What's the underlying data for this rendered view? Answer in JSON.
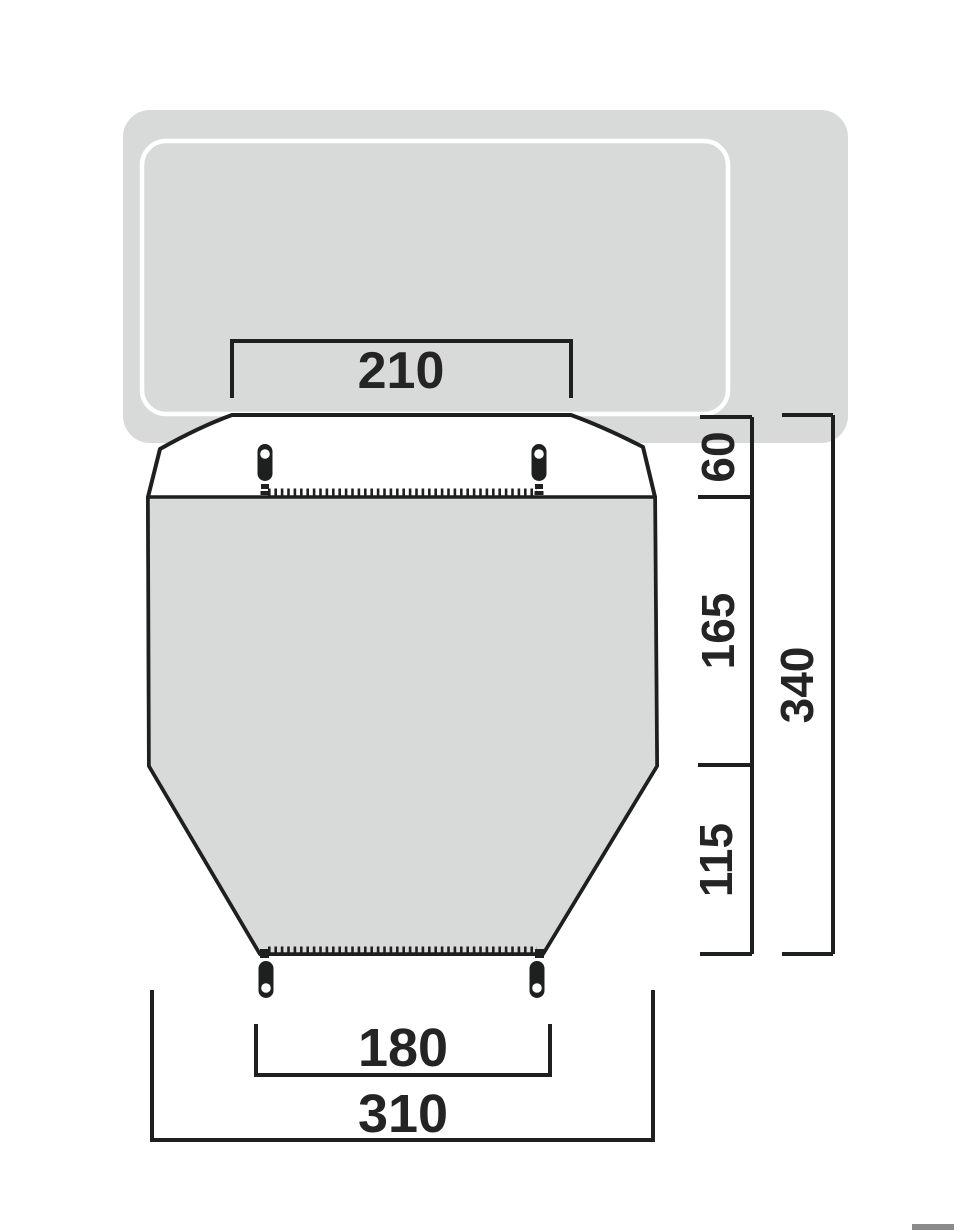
{
  "diagram": {
    "title": "tent-footprint-dimension-diagram",
    "measurements": {
      "attachment_width": "210",
      "connection_depth": "60",
      "main_section_depth": "165",
      "front_section_depth": "115",
      "total_depth": "340",
      "rear_ground_width": "180",
      "ground_width": "310"
    },
    "colors": {
      "vehicle_fill": "#d8dada",
      "tent_body_fill": "#d8dada",
      "outline": "#1e1f1f",
      "label_text": "#242424",
      "inner_outline": "#ffffff",
      "corner_bar": "#8b8b8b"
    }
  }
}
